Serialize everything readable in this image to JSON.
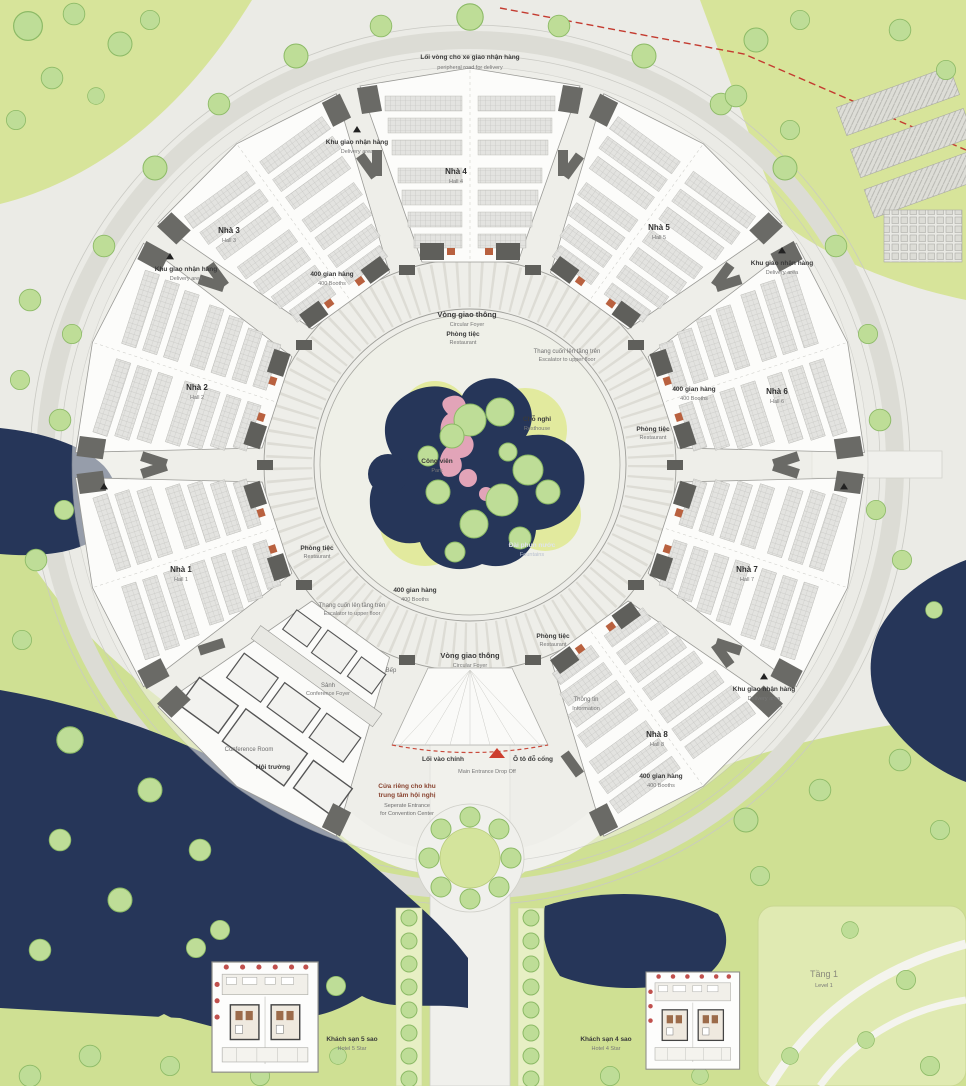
{
  "halls": [
    {
      "vi": "Nhà 1",
      "en": "Hall 1"
    },
    {
      "vi": "Nhà 2",
      "en": "Hall 2"
    },
    {
      "vi": "Nhà 3",
      "en": "Hall 3"
    },
    {
      "vi": "Nhà 4",
      "en": "Hall 4"
    },
    {
      "vi": "Nhà 5",
      "en": "Hall 5"
    },
    {
      "vi": "Nhà 6",
      "en": "Hall 6"
    },
    {
      "vi": "Nhà 7",
      "en": "Hall 7"
    },
    {
      "vi": "Nhà 8",
      "en": "Hall 8"
    }
  ],
  "labels": {
    "ring_road": {
      "vi": "Lối vòng cho xe giao nhận hàng",
      "en": "peripheral road for delivery"
    },
    "delivery": {
      "vi": "Khu giao nhận hàng",
      "en": "Delivery area"
    },
    "booths": {
      "vi": "400 gian hàng",
      "en": "400 Booths"
    },
    "circular_foyer": {
      "vi": "Vòng giao thông",
      "en": "Circular Foyer"
    },
    "restaurant": {
      "vi": "Phòng tiệc",
      "en": "Restaurant"
    },
    "escalator": {
      "vi": "Thang cuốn lên tầng trên",
      "en": "Escalator to upper floor"
    },
    "resthouse": {
      "vi": "Chỗ nghỉ",
      "en": "Resthouse"
    },
    "park": {
      "vi": "Công viên",
      "en": "Park"
    },
    "fountain": {
      "vi": "Đài phun nước",
      "en": "Fountains"
    },
    "kitchen": {
      "vi": "Bếp"
    },
    "information": {
      "vi": "Thông tin",
      "en": "Information"
    },
    "conference_foyer": {
      "vi": "Sảnh",
      "en": "Conference Foyer"
    },
    "conference_room": {
      "en": "Conference Room"
    },
    "auditorium": {
      "vi": "Hội trường"
    },
    "entrance": {
      "vi_left": "Lối vào chính",
      "vi_right": "Ô tô đỗ cổng",
      "en": "Main Entrance Drop Off"
    },
    "separate_entrance": {
      "vi1": "Cửa riêng cho khu",
      "vi2": "trung tâm hội nghị",
      "en1": "Seperate Entrance",
      "en2": "for Convention Center"
    },
    "hotel5": {
      "vi": "Khách sạn 5 sao",
      "en": "Hotel 5 Star"
    },
    "hotel4": {
      "vi": "Khách sạn 4 sao",
      "en": "Hotel 4 Star"
    },
    "floor": {
      "vi": "Tầng 1",
      "en": "Level 1"
    }
  },
  "colors": {
    "background": "#ebebe6",
    "greenery": "#d7e49a",
    "tree": "#bedd97",
    "water": "#263659",
    "hall_fill": "#fcfcfa",
    "booth_fill": "#e3e3e0",
    "core_block": "#5f5f5f",
    "accent_red": "#c23b2e",
    "pink_path": "#e2a4b8"
  }
}
